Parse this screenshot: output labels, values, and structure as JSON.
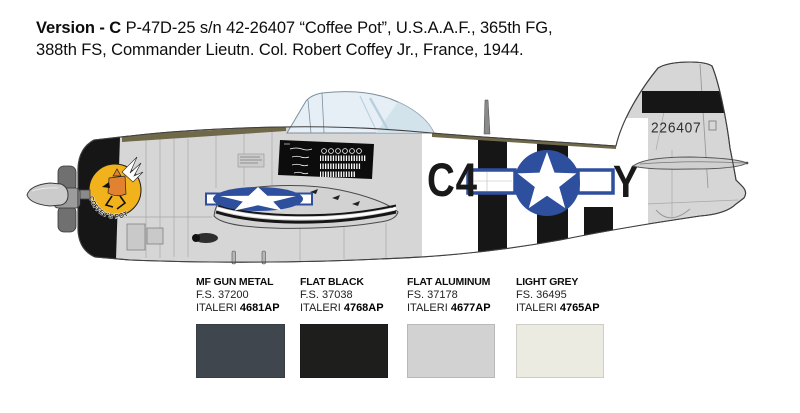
{
  "header": {
    "version_label": "Version - C",
    "line1_rest": " P-47D-25 s/n 42-26407 “Coffee Pot”, U.S.A.A.F., 365th FG,",
    "line2": "388th FS, Commander Lieutn. Col. Robert Coffey Jr., France, 1944."
  },
  "aircraft": {
    "code_left": "C4",
    "code_right": "Y",
    "tail_serial": "226407",
    "nose_art_text": "COFFEY'S POT",
    "colors": {
      "insignia_blue": "#2d4f9e",
      "nose_emblem_yellow": "#f2b21b",
      "nose_char_orange": "#e0822f",
      "olive_antiglare": "#6f694a",
      "fuselage_grey": "#d6d6d6",
      "stripe_white": "#ffffff",
      "stripe_black": "#161616",
      "canopy_blue": "#e6eff5"
    }
  },
  "paints": [
    {
      "name": "MF GUN METAL",
      "fs": "F.S. 37200",
      "brand": "ITALERI",
      "code": "4681AP",
      "hex": "#40464d"
    },
    {
      "name": "FLAT BLACK",
      "fs": "F.S. 37038",
      "brand": "ITALERI",
      "code": "4768AP",
      "hex": "#1e1e1c"
    },
    {
      "name": "FLAT ALUMINUM",
      "fs": "FS. 37178",
      "brand": "ITALERI",
      "code": "4677AP",
      "hex": "#d2d2d2"
    },
    {
      "name": "LIGHT GREY",
      "fs": "FS. 36495",
      "brand": "ITALERI",
      "code": "4765AP",
      "hex": "#ecebe2"
    }
  ]
}
